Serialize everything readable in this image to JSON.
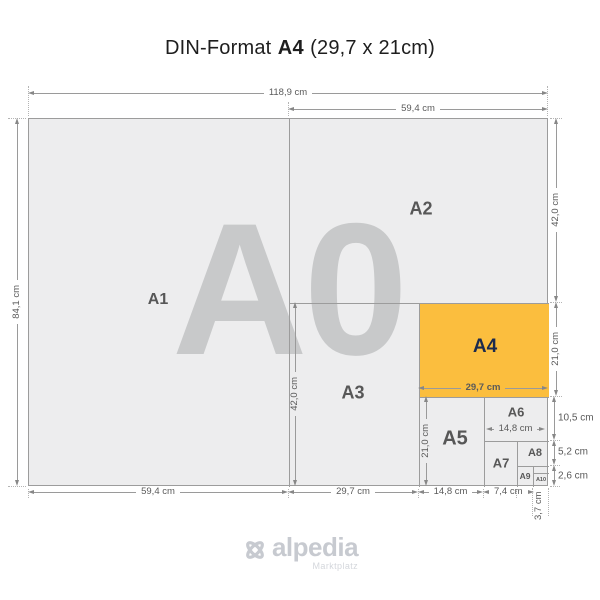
{
  "title": {
    "prefix": "DIN-Format",
    "emphasis": "A4",
    "suffix": "(29,7 x 21cm)"
  },
  "watermark": "A0",
  "regions": {
    "a1": "A1",
    "a2": "A2",
    "a3": "A3",
    "a4": "A4",
    "a5": "A5",
    "a6": "A6",
    "a7": "A7",
    "a8": "A8",
    "a9": "A9",
    "a10": "A10"
  },
  "dimensions": {
    "a0_width": "118,9 cm",
    "a0_height": "84,1 cm",
    "a1_width": "59,4 cm",
    "a2_width": "59,4 cm",
    "a2_height": "42,0 cm",
    "a3_width": "29,7 cm",
    "a3_height": "42,0 cm",
    "a4_width": "29,7 cm",
    "a4_height": "21,0 cm",
    "a5_width": "14,8 cm",
    "a5_height": "21,0 cm",
    "a6_width": "14,8 cm",
    "a6_height": "10,5 cm",
    "a7_width": "7,4 cm",
    "a8_height": "5,2 cm",
    "a9_height": "5,2 cm",
    "a10_width": "3,7 cm",
    "a10_height": "2,6 cm"
  },
  "logo": {
    "name": "alpedia",
    "tagline": "Marktplatz"
  },
  "colors": {
    "a4_fill": "#FBBE3E",
    "a4_label": "#1C2B4D"
  }
}
